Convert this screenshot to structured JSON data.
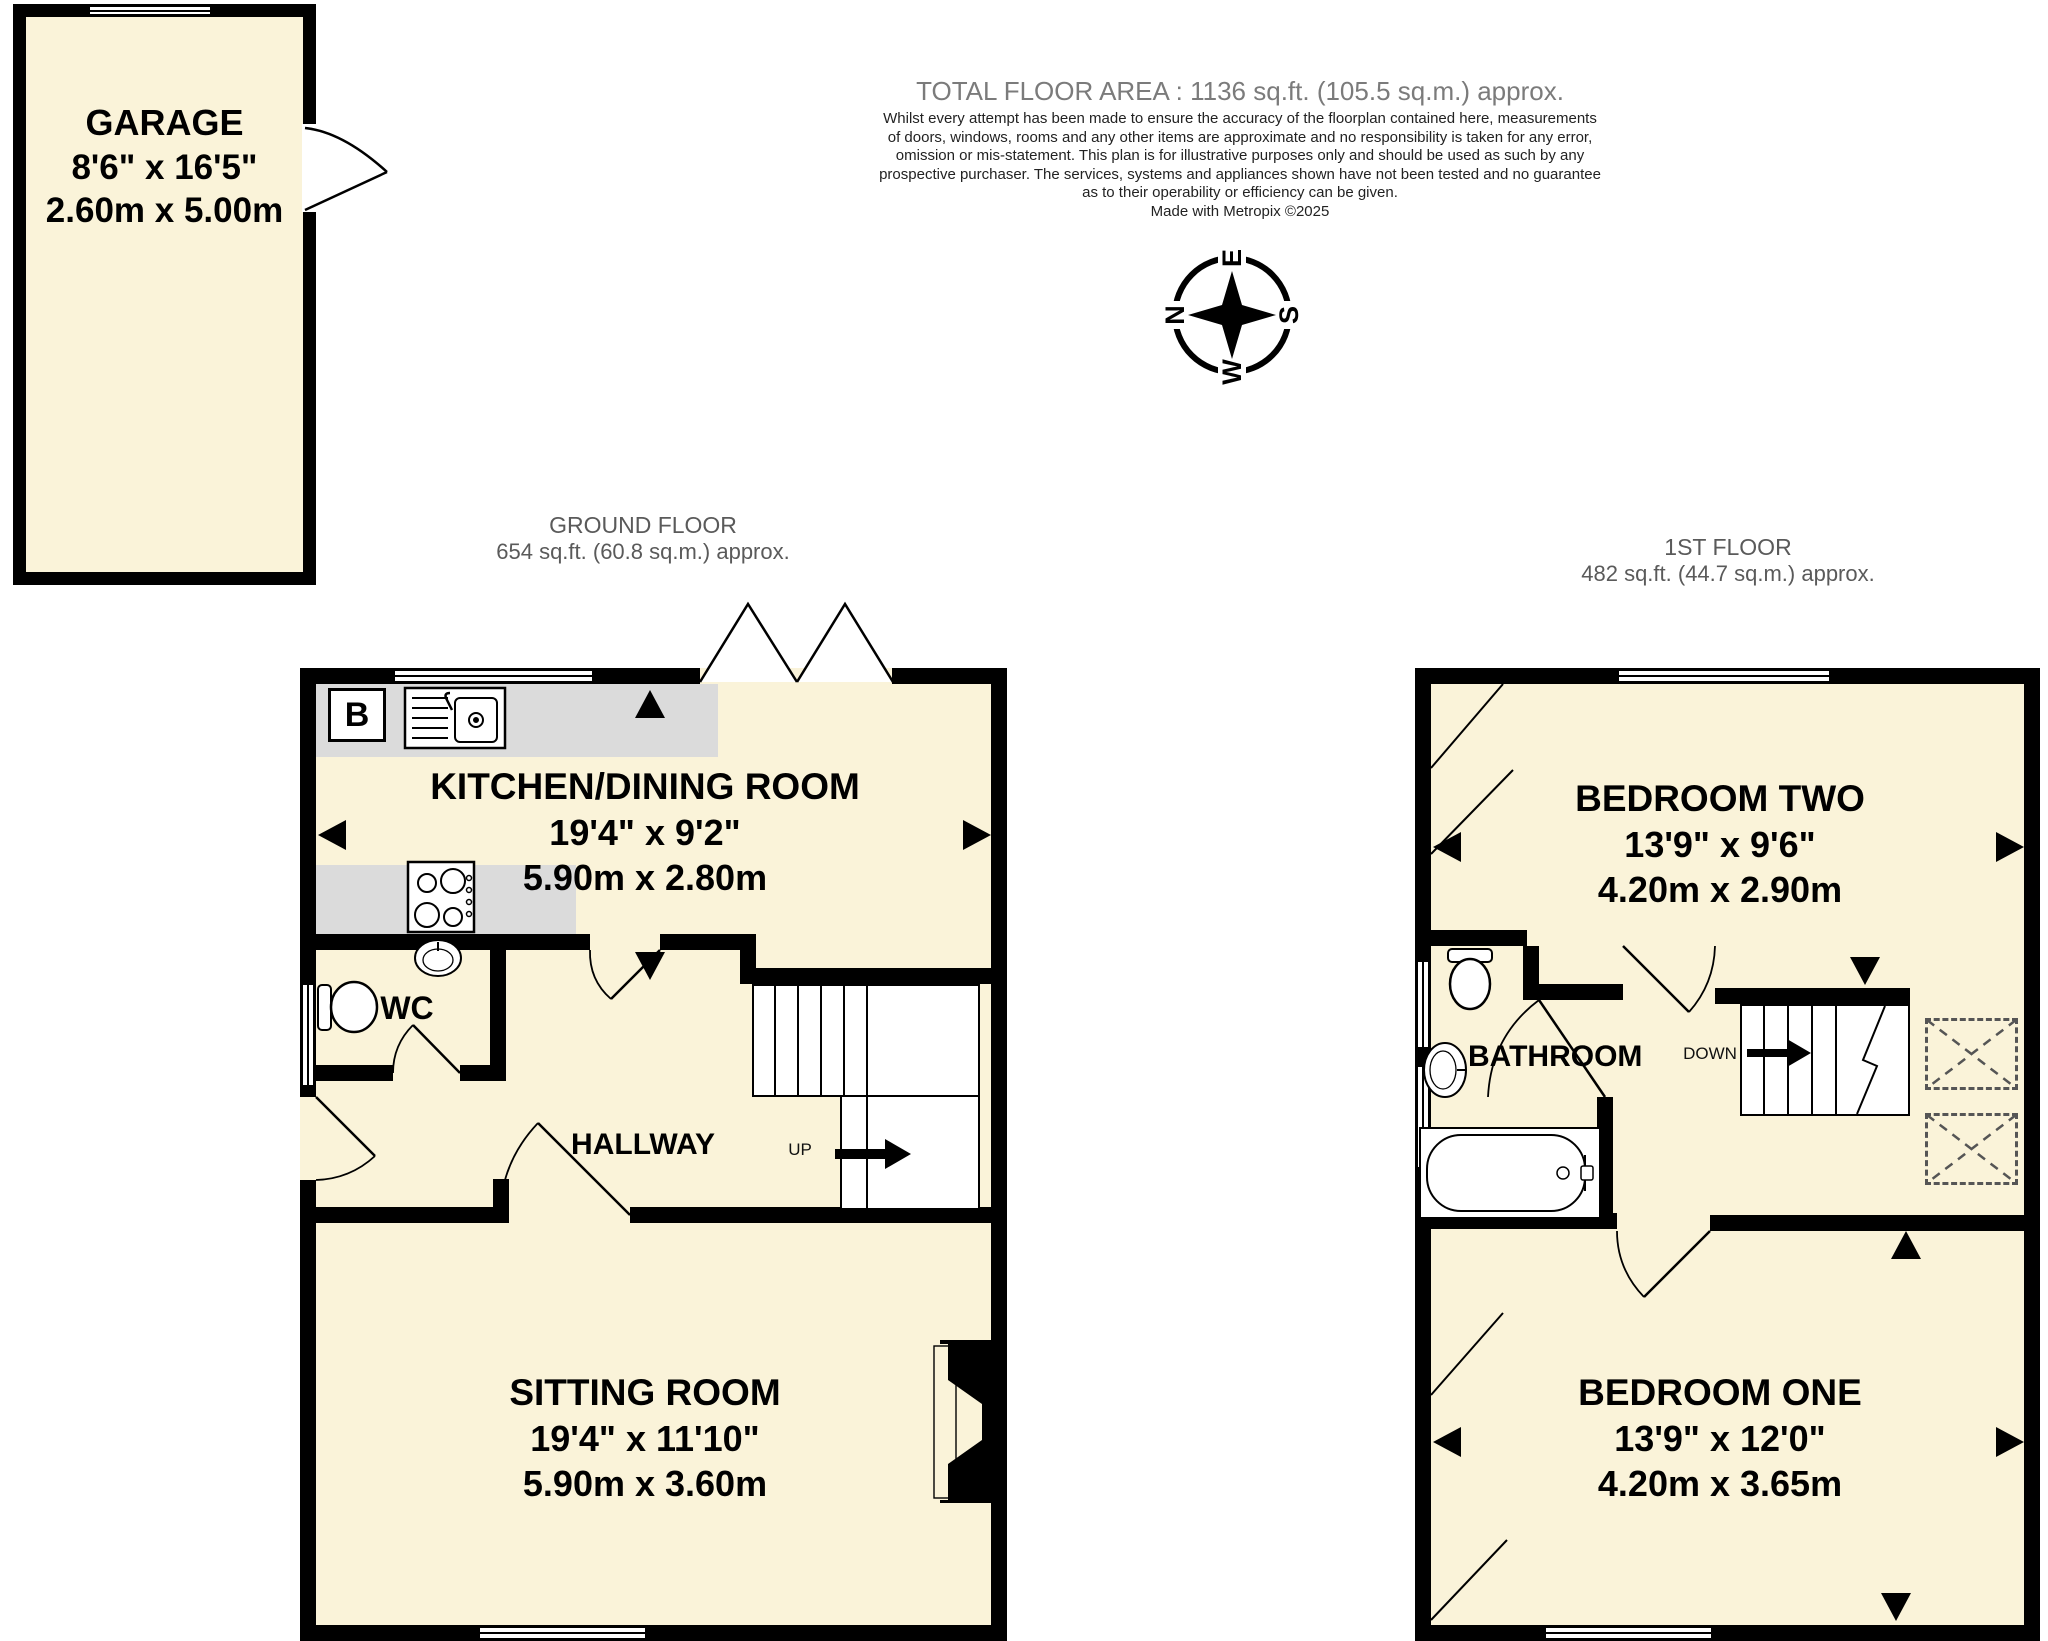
{
  "header": {
    "total_area": "TOTAL FLOOR AREA : 1136 sq.ft. (105.5 sq.m.) approx.",
    "disclaimer": [
      "Whilst every attempt has been made to ensure the accuracy of the floorplan contained here, measurements",
      "of doors, windows, rooms and any other items are approximate and no responsibility is taken for any error,",
      "omission or mis-statement. This plan is for illustrative purposes only and should be used as such by any",
      "prospective purchaser. The services, systems and appliances shown have not been tested and no guarantee",
      "as to their operability or efficiency can be given.",
      "Made with Metropix ©2025"
    ]
  },
  "compass": {
    "north": "N",
    "east": "E",
    "south": "S",
    "west": "W"
  },
  "garage": {
    "name": "GARAGE",
    "imperial": "8'6\" x 16'5\"",
    "metric": "2.60m x 5.00m"
  },
  "ground_floor": {
    "label": "GROUND FLOOR",
    "area": "654 sq.ft. (60.8 sq.m.) approx.",
    "kitchen": {
      "name": "KITCHEN/DINING ROOM",
      "imperial": "19'4\" x 9'2\"",
      "metric": "5.90m x 2.80m"
    },
    "wc": {
      "name": "WC"
    },
    "hallway": {
      "name": "HALLWAY"
    },
    "sitting_room": {
      "name": "SITTING ROOM",
      "imperial": "19'4\" x 11'10\"",
      "metric": "5.90m x 3.60m"
    },
    "stairs": {
      "direction": "UP"
    },
    "boiler": {
      "label": "B"
    }
  },
  "first_floor": {
    "label": "1ST FLOOR",
    "area": "482 sq.ft. (44.7 sq.m.) approx.",
    "bedroom_two": {
      "name": "BEDROOM TWO",
      "imperial": "13'9\" x 9'6\"",
      "metric": "4.20m x 2.90m"
    },
    "bathroom": {
      "name": "BATHROOM"
    },
    "stairs": {
      "direction": "DOWN"
    },
    "bedroom_one": {
      "name": "BEDROOM ONE",
      "imperial": "13'9\" x 12'0\"",
      "metric": "4.20m x 3.65m"
    }
  },
  "icons": {
    "compass-rose-icon": "4-point star",
    "dimension-arrow-icon": "solid black triangle",
    "stairs-arrow-icon": "solid black arrow",
    "skylight-icon": "dashed box with X"
  },
  "colors": {
    "room_fill": "#FAF3D9",
    "counter": "#DBDBDB",
    "wall": "#000000",
    "muted_heading": "#7B7B7B",
    "floor_label": "#5A5A5A"
  }
}
